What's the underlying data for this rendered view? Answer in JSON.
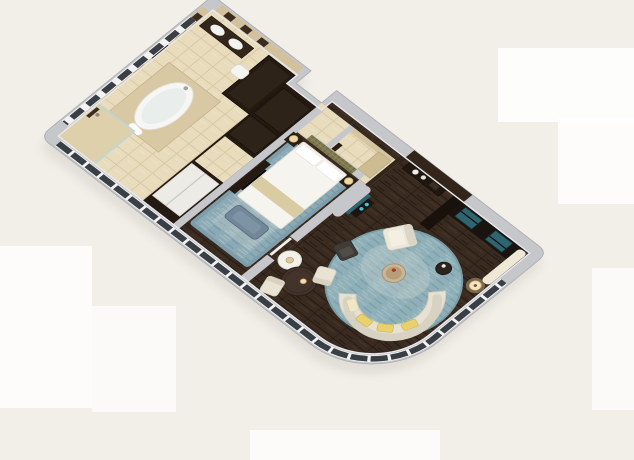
{
  "scene": {
    "type": "3d-floor-plan-rendering",
    "subject": "isometric cutaway rendering of a hotel suite floor plan",
    "rooms": [
      {
        "name": "bathroom",
        "features": [
          "oval-bathtub",
          "tub-platform",
          "walk-in-shower",
          "double-vanity",
          "toilet",
          "stone-niche-walls",
          "wall-art-panel",
          "wardrobe"
        ]
      },
      {
        "name": "dressing-closet",
        "features": [
          "dark-cabinets",
          "white-sliding-door",
          "passage"
        ]
      },
      {
        "name": "bedroom",
        "features": [
          "double-bed",
          "white-duvet",
          "pillows",
          "gold-bed-runner",
          "blue-bench",
          "nightstands",
          "table-lamps",
          "distressed-blue-rug",
          "mosaic-headboard-wall",
          "dresser"
        ]
      },
      {
        "name": "hallway",
        "features": [
          "tile-floor"
        ]
      },
      {
        "name": "powder-room",
        "features": [
          "stone-bench",
          "tile-floor"
        ]
      },
      {
        "name": "entry-foyer",
        "features": [
          "dark-brown-walls",
          "console-table",
          "vases",
          "tall-cabinet"
        ]
      },
      {
        "name": "living-room",
        "features": [
          "round-blue-rug",
          "curved-cream-sofa",
          "yellow-pillows",
          "armchair",
          "lounge-chair",
          "round-coffee-table",
          "side-table",
          "media-wall-teal-glass-panels",
          "floor-lamp",
          "sheer-curtain",
          "curved-window-facade"
        ]
      },
      {
        "name": "dining-nook",
        "features": [
          "round-dark-table",
          "two-cream-chairs",
          "white-drum-table",
          "candle"
        ]
      }
    ]
  },
  "colors": {
    "background": "#f2efe9",
    "artifact": "#ffffff",
    "wall_top": "#c6c7cb",
    "wall_edge": "#aeafb3",
    "wall_inner": "#e8e9ec",
    "wall_dark": "#34251b",
    "wood": "#3a2b20",
    "wood_dark": "#241a12",
    "tile": "#e8dcbd",
    "stone": "#d2c19c",
    "platform": "#d9c8a4",
    "tub": "#f6f7f5",
    "rug_living": "#92b4be",
    "rug_bedroom": "#8caab6",
    "rug_wash": "#c6cfca",
    "teal": "#2f6571",
    "cyan": "#3ec8d4",
    "mosaic": "#7f7a4c",
    "sofa": "#e7e1d3",
    "sofa_trim": "#d2cbba",
    "pillow": "#e9d26e",
    "bench": "#72879a",
    "bed": "#f6f4ee",
    "runner": "#d9cba2",
    "furniture_dark": "#241a12",
    "table_wood": "#42332b",
    "chair": "#e9e3d4",
    "lamp": "#f2d79e",
    "glass": "#3a3f45",
    "mullion": "#f2f2f2",
    "shadow": "#d5d1c9"
  }
}
